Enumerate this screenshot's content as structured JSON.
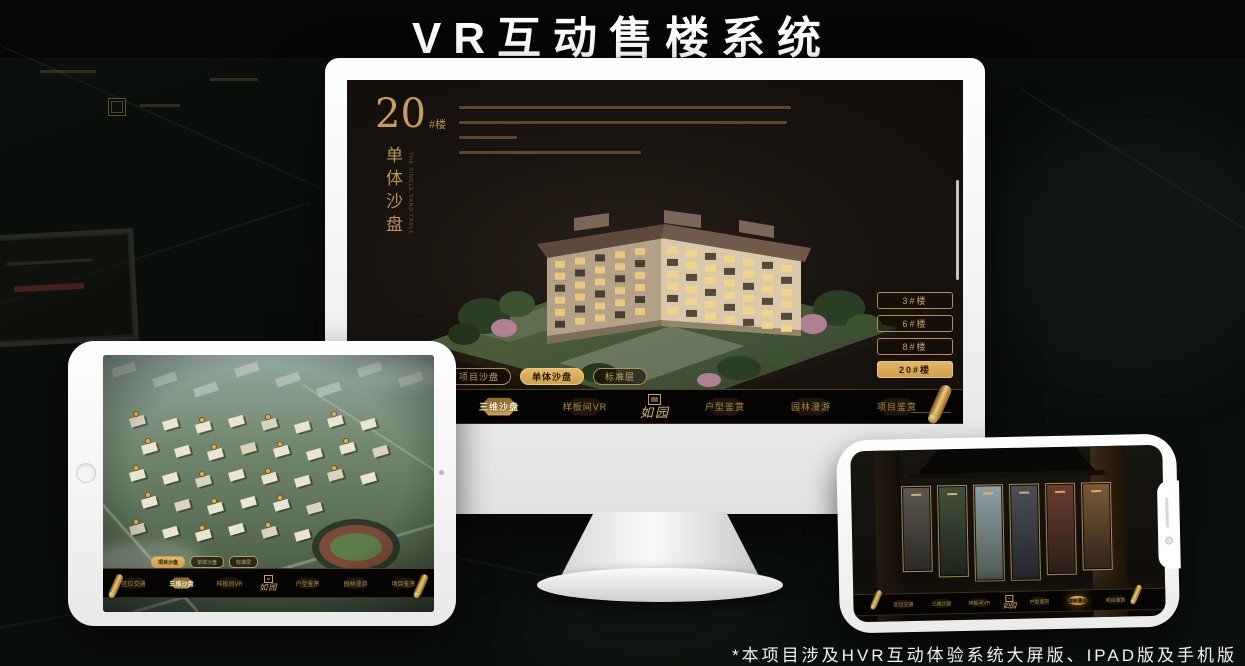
{
  "page": {
    "title": "VR互动售楼系统",
    "footnote": "*本项目涉及HVR互动体验系统大屏版、IPAD版及手机版"
  },
  "colors": {
    "gold": "#c29a5c",
    "gold_fill": "#d9ac5b",
    "screen_bg": "#171310",
    "nav_bg": "#060402",
    "background": "#0b100d"
  },
  "monitor": {
    "panel_title": {
      "number": "20",
      "suffix": "#楼",
      "subtitle": "单体沙盘",
      "subtitle_en": "THE SINGLE SAND TABLE"
    },
    "building_buttons": [
      {
        "label": "3#楼",
        "active": false
      },
      {
        "label": "6#楼",
        "active": false
      },
      {
        "label": "8#楼",
        "active": false
      },
      {
        "label": "20#楼",
        "active": true
      }
    ],
    "view_tabs": [
      {
        "label": "项目沙盘",
        "active": false
      },
      {
        "label": "单体沙盘",
        "active": true
      },
      {
        "label": "标准层",
        "active": false
      }
    ],
    "nav": {
      "left": [
        "区位交通",
        "三维沙盘",
        "样板间VR"
      ],
      "logo": "如园",
      "right": [
        "户型鉴赏",
        "园林漫游",
        "项目鉴赏"
      ],
      "active": "三维沙盘"
    }
  },
  "ipad": {
    "view_tabs": [
      {
        "label": "项目沙盘",
        "active": true
      },
      {
        "label": "单体沙盘",
        "active": false
      },
      {
        "label": "标准层",
        "active": false
      }
    ],
    "nav": {
      "left": [
        "区位交通",
        "三维沙盘",
        "样板间VR"
      ],
      "logo": "如园",
      "right": [
        "户型鉴赏",
        "园林漫游",
        "项目鉴赏"
      ],
      "active": "三维沙盘"
    }
  },
  "phone": {
    "nav": {
      "left": [
        "区位交通",
        "三维沙盘",
        "样板间VR"
      ],
      "logo": "如园",
      "right": [
        "户型鉴赏",
        "园林漫游",
        "项目鉴赏"
      ],
      "active": "园林漫游"
    },
    "scene_card_count": "6"
  }
}
